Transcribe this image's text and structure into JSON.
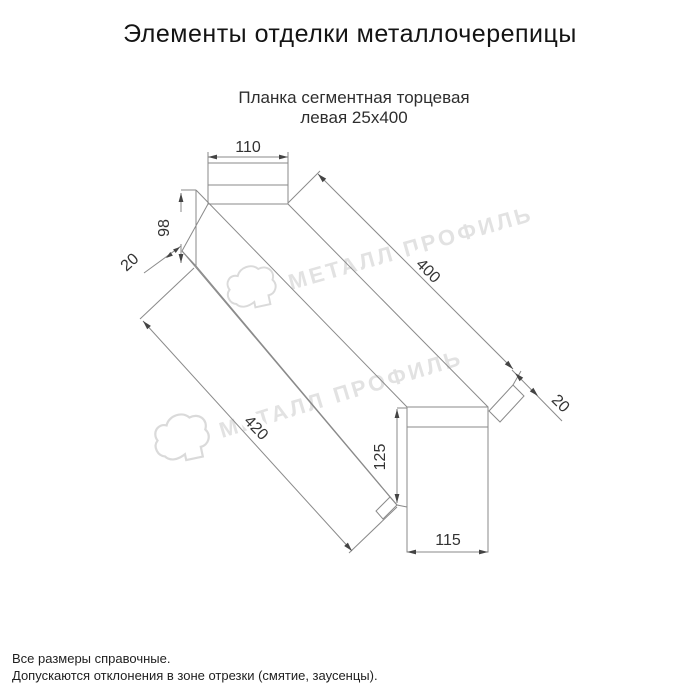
{
  "window": {
    "title": "Элементы отделки металлочерепицы"
  },
  "product": {
    "subtitle_line1": "Планка сегментная торцевая",
    "subtitle_line2": "левая 25х400"
  },
  "drawing": {
    "type": "technical-dimension-drawing",
    "dimensions": {
      "top_flange_width": "110",
      "left_face_height": "98",
      "left_hem": "20",
      "top_edge_length": "400",
      "bottom_edge_length": "420",
      "end_face_height": "125",
      "end_face_width": "115",
      "end_hem": "20"
    }
  },
  "watermark": {
    "brand": "МЕТАЛЛ ПРОФИЛЬ",
    "text_color": "#e2e2e2"
  },
  "footer": {
    "note1": "Все размеры справочные.",
    "note2": "Допускаются отклонения в зоне отрезки (смятие, заусенцы)."
  },
  "colors": {
    "object_line": "#8a8a8a",
    "label": "#333333",
    "background": "#ffffff"
  }
}
